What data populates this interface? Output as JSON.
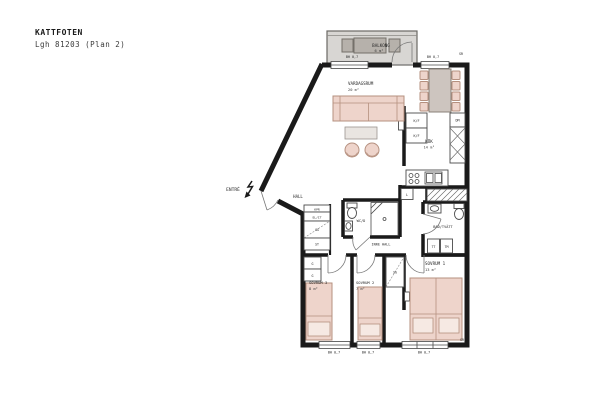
{
  "header": {
    "project": "KATTFOTEN",
    "apartment": "Lgh 81203 (Plan 2)"
  },
  "entrance": {
    "label": "ENTRÉ"
  },
  "rooms": {
    "balcony": {
      "name": "BALKONG",
      "area": "6 m²"
    },
    "living": {
      "name": "VARDAGSRUM",
      "area": "20 m²"
    },
    "kitchen": {
      "name": "KÖK",
      "area": "14 m²"
    },
    "hall": {
      "name": "HALL"
    },
    "inner_hall": {
      "name": "INRE HALL"
    },
    "wc": {
      "name": "WC/D"
    },
    "bath": {
      "name": "BAD/TVÄTT"
    },
    "bedroom1": {
      "name": "SOVRUM 1",
      "area": "13 m²"
    },
    "bedroom2": {
      "name": "SOVRUM 2",
      "area": "7 m²"
    },
    "bedroom3": {
      "name": "SOVRUM 3",
      "area": "8 m²"
    }
  },
  "fixtures": {
    "fridge_freezer": "K/F",
    "dishwasher": "DM",
    "linen_closet": "L",
    "wardrobe": "G",
    "sliding_wardrobe": "SG",
    "cleaning_closet": "ST",
    "electrical": "EL/IT",
    "coat_rack": "KPR",
    "dryer": "TT",
    "washer": "TM"
  },
  "annotations": {
    "window_height": "BH 0,7",
    "shaft": "SR"
  },
  "colors": {
    "wall": "#1a1a1a",
    "furniture_fill": "#eed4cb",
    "furniture_stroke": "#b5907f",
    "balcony_fill": "#d8d6d3",
    "balcony_furniture": "#b6b1ab"
  }
}
